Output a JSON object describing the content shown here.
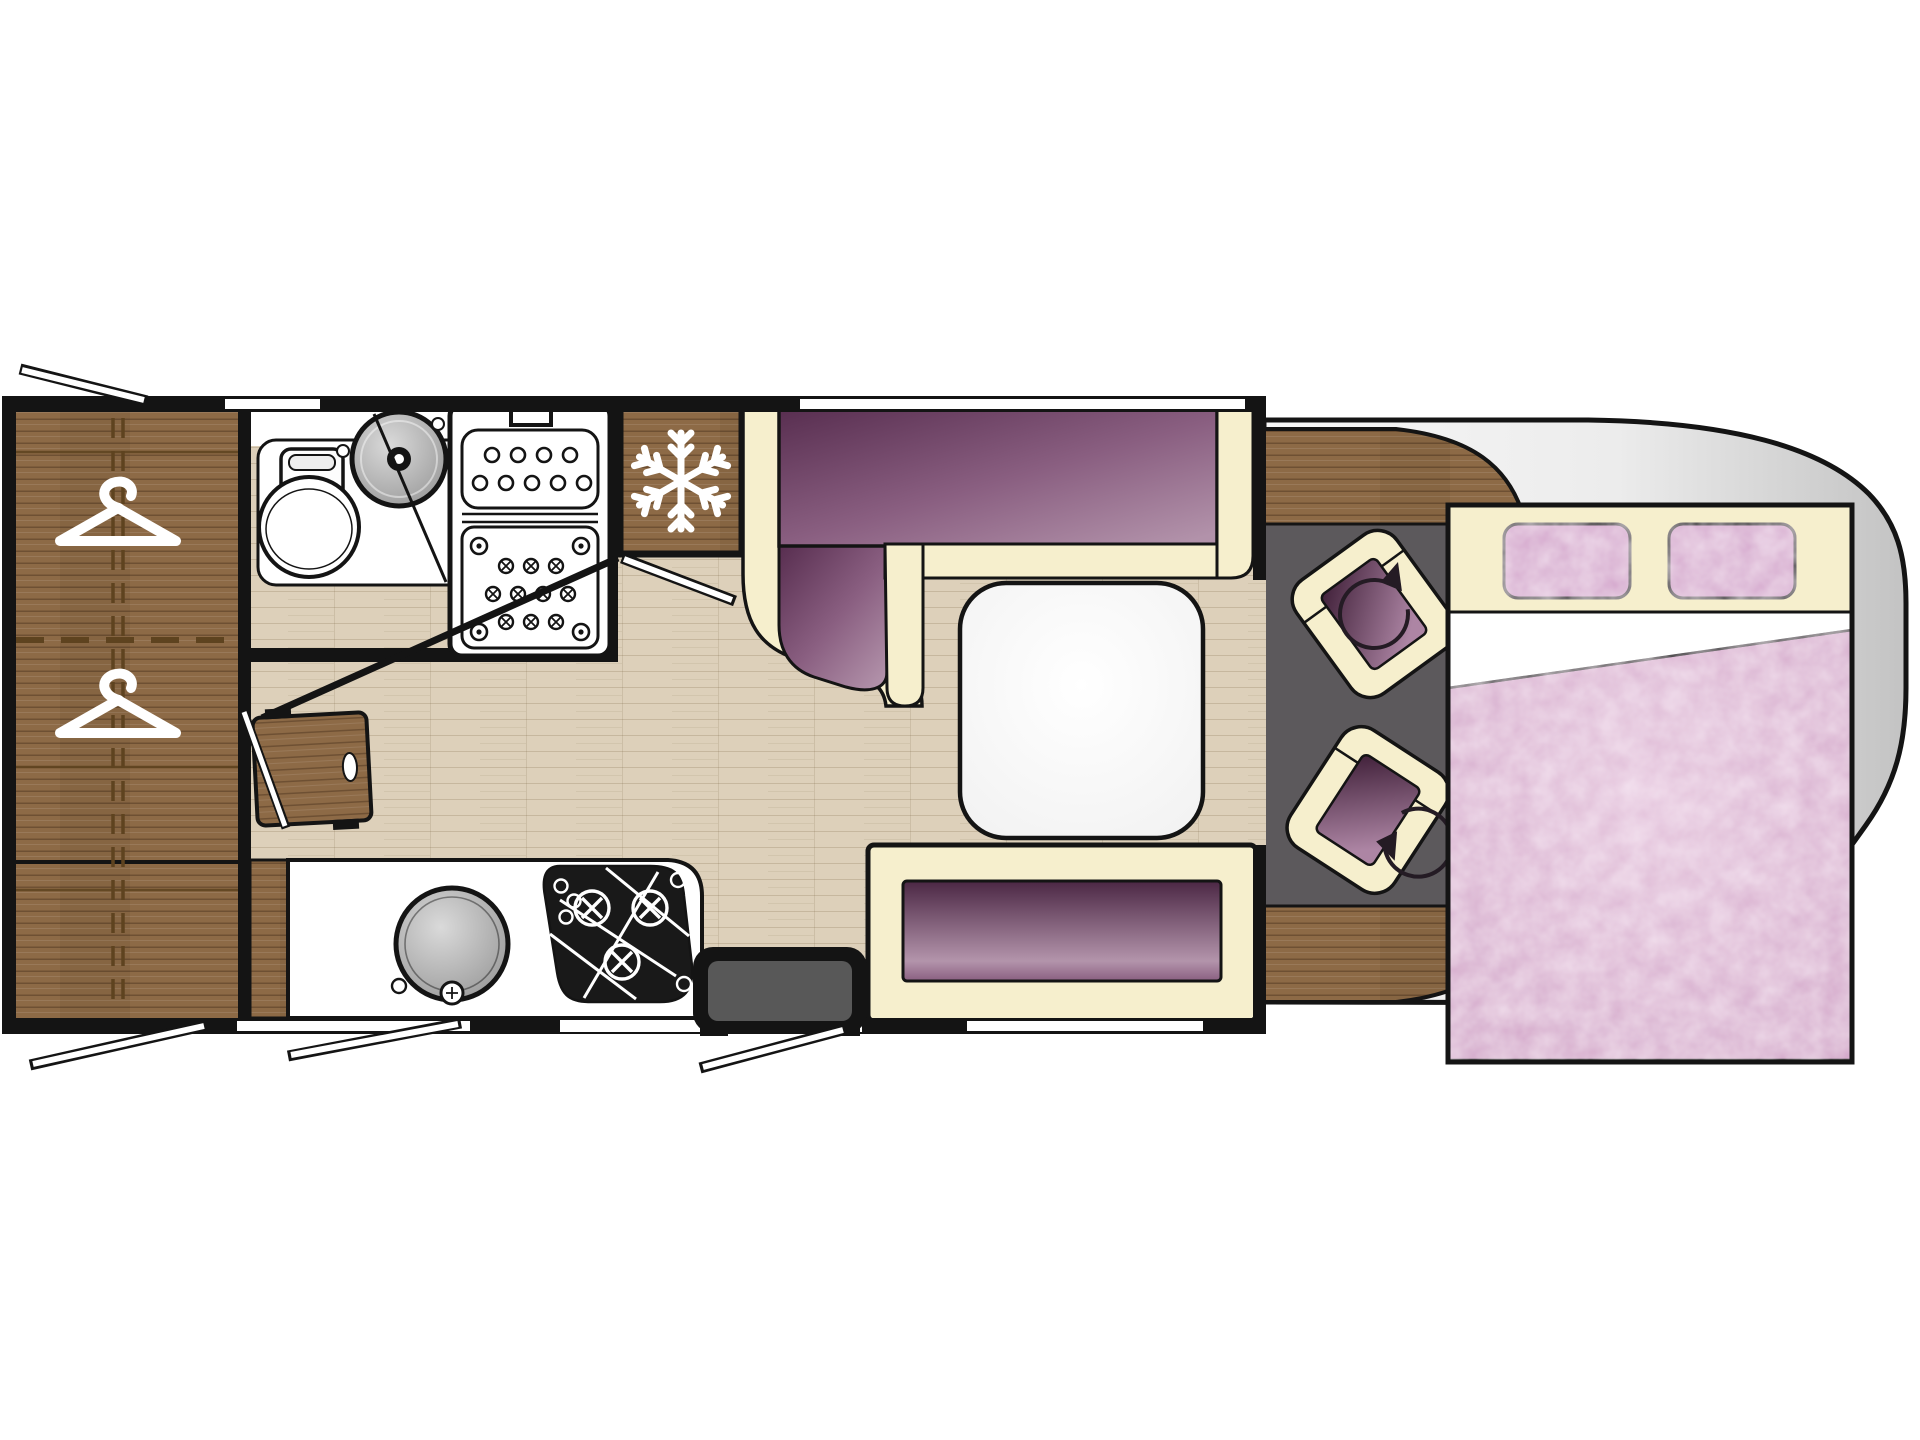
{
  "scene": {
    "kind": "motorhome floor plan, top-down view"
  },
  "colors": {
    "wall": "#141414",
    "white": "#ffffff",
    "wood": "#8d6a46",
    "wood-line": "#5e431f",
    "floor": "#ddd0ba",
    "floor-line": "#b49a76",
    "cream": "#f6efcd",
    "purple-dark": "#572d4f",
    "purple-mid": "#8a5f81",
    "purple-light": "#b292aa",
    "bench-dark": "#4b2744",
    "bench-light": "#b394ab",
    "seat-dark": "#402039",
    "seat-light": "#ad85a4",
    "pink-pillow": "#d5a9ce",
    "pink-duvet": "#cfa0c5",
    "pink-duvet-light": "#e3c2db",
    "cab-floor": "#5c595c",
    "cab-body-light": "#f7f7f7",
    "cab-body-dark": "#c3c3c3",
    "sink-light": "#dadada",
    "sink-dark": "#8c8c8c",
    "step-inner": "#585858",
    "arrow": "#241b24"
  },
  "areas": {
    "wardrobe": {
      "icons": [
        "clothes-hanger-icon",
        "clothes-hanger-icon"
      ]
    },
    "bathroom": {
      "fixtures": [
        "toilet",
        "washbasin",
        "shower-tray",
        "shower-screen"
      ]
    },
    "fridge": {
      "icon": "snowflake-icon"
    },
    "kitchen": {
      "fixtures": [
        "round-sink",
        "three-burner-hob",
        "worktop"
      ]
    },
    "dinette": {
      "fixtures": [
        "l-shaped-sofa",
        "pedestal-table",
        "side-bench"
      ]
    },
    "cab": {
      "fixtures": [
        "swivel-seat",
        "swivel-seat",
        "dashboard"
      ],
      "icons": [
        "rotation-arrow-icon",
        "rotation-arrow-icon"
      ]
    },
    "bed": {
      "fixtures": [
        "drop-down-double-bed",
        "pillow",
        "pillow",
        "duvet"
      ]
    },
    "entrance": {
      "fixtures": [
        "entry-step",
        "open-door-swing"
      ]
    },
    "openings": {
      "fixtures": [
        "window",
        "window",
        "window",
        "window",
        "open-window-swing",
        "open-window-swing",
        "open-window-swing"
      ]
    }
  }
}
